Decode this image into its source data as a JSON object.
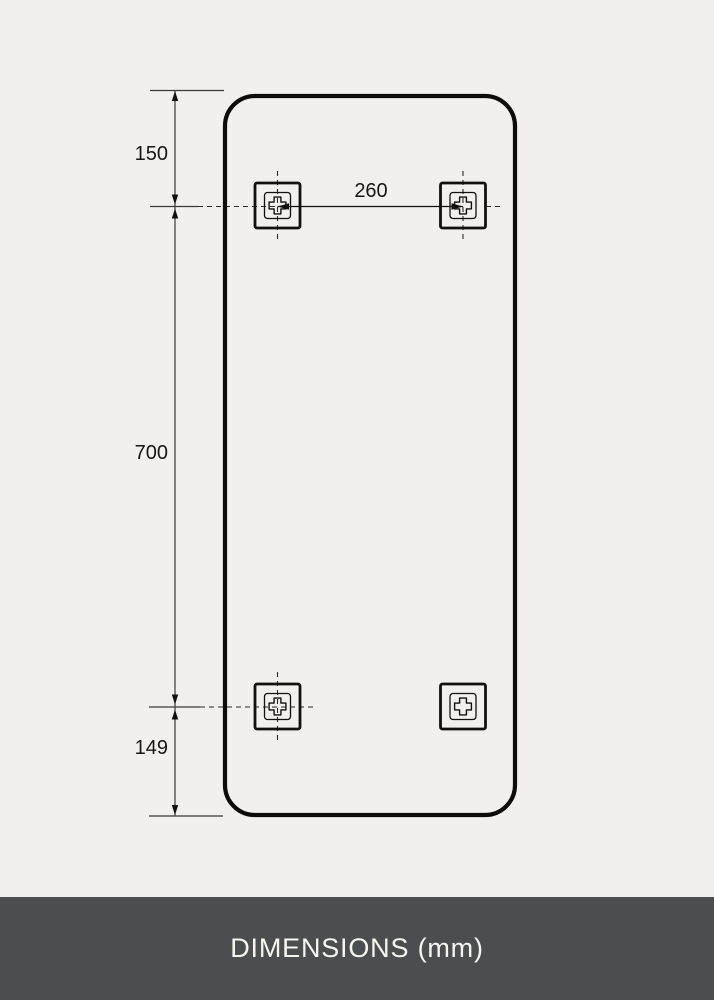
{
  "diagram": {
    "dimension_labels": {
      "top_offset": "150",
      "bracket_spacing": "260",
      "vertical_span": "700",
      "bottom_offset": "149"
    },
    "brackets": [
      {
        "position": "top-left"
      },
      {
        "position": "top-right"
      },
      {
        "position": "bottom-left"
      },
      {
        "position": "bottom-right"
      }
    ],
    "colors": {
      "background": "#f1f0ee",
      "outline": "#111111",
      "dimension_line": "#3a3a3a",
      "footer_background": "#4c4d4f",
      "footer_text": "#f6f5f2"
    }
  },
  "footer": {
    "label": "DIMENSIONS (mm)"
  }
}
